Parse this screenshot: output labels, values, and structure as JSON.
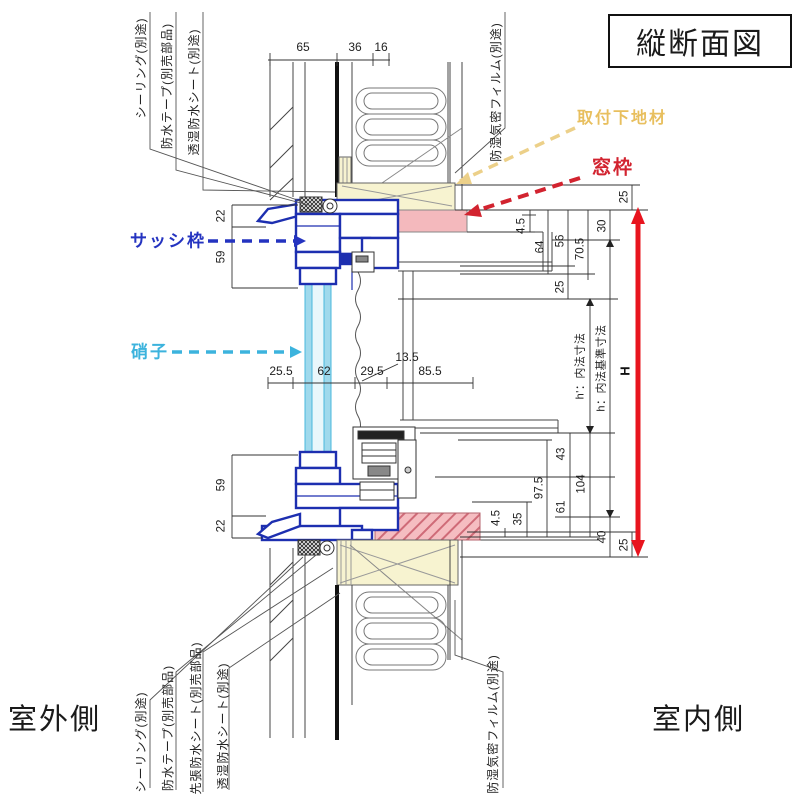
{
  "title": "縦断面図",
  "sides": {
    "outdoor": "室外側",
    "indoor": "室内側"
  },
  "callouts": {
    "sash_frame": {
      "label": "サッシ枠",
      "color": "#2433c0"
    },
    "glass": {
      "label": "硝子",
      "color": "#3cb3dd"
    },
    "mounting_base": {
      "label": "取付下地材",
      "color": "#e8bf5e"
    },
    "window_frame": {
      "label": "窓枠",
      "color": "#d2232f"
    }
  },
  "part_labels": {
    "top_left": [
      "シーリング(別途)",
      "防水テープ(別売部品)",
      "透湿防水シート(別途)"
    ],
    "top_right": [
      "防湿気密フィルム(別途)"
    ],
    "bottom_left": [
      "シーリング(別途)",
      "防水テープ(別売部品)",
      "先張防水シート(別売部品)",
      "透湿防水シート(別途)"
    ],
    "bottom_right": [
      "防湿気密フィルム(別途)"
    ]
  },
  "dims": {
    "top": [
      "65",
      "36",
      "16"
    ],
    "middle": [
      "25.5",
      "62",
      "29.5",
      "85.5"
    ],
    "film_offset": "13.5",
    "left_top": [
      "22",
      "59"
    ],
    "left_bottom": [
      "59",
      "22"
    ],
    "right_top": [
      "4.5",
      "64",
      "56",
      "25",
      "70.5",
      "30",
      "25"
    ],
    "right_bottom": [
      "4.5",
      "35",
      "97.5",
      "43",
      "61",
      "104",
      "40",
      "25"
    ],
    "height": {
      "h_prime": "h'：内法寸法",
      "h_standard": "h：内法基準寸法",
      "H": "H"
    }
  },
  "colors": {
    "sash_blue": "#1d2fb0",
    "glass_cyan": "#49b8dc",
    "window_frame_pink": "#f4b9bd",
    "mounting_base_yellow": "#f7f3d0",
    "height_arrow_red": "#e8141e"
  }
}
